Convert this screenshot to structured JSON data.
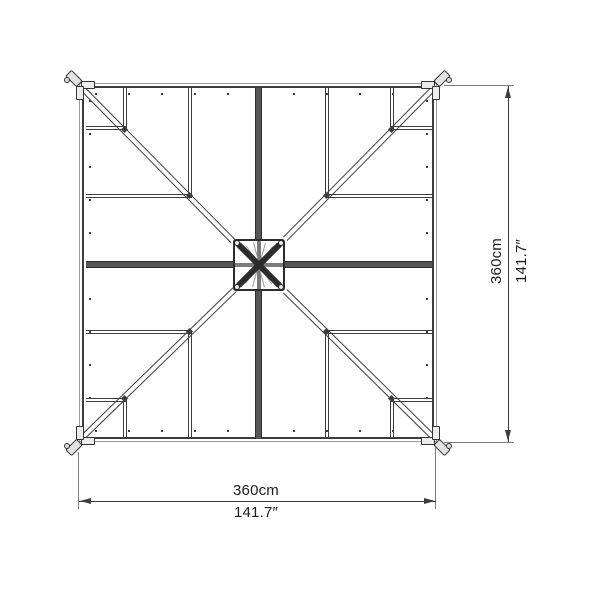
{
  "colors": {
    "line": "#3d3d3d",
    "line-light": "#9b9b9b",
    "beam": "#2c2c2c",
    "text": "#1c1c1c",
    "background": "#ffffff"
  },
  "dimensions": {
    "width": {
      "metric": "360cm",
      "imperial": "141.7″"
    },
    "height": {
      "metric": "360cm",
      "imperial": "141.7″"
    }
  }
}
